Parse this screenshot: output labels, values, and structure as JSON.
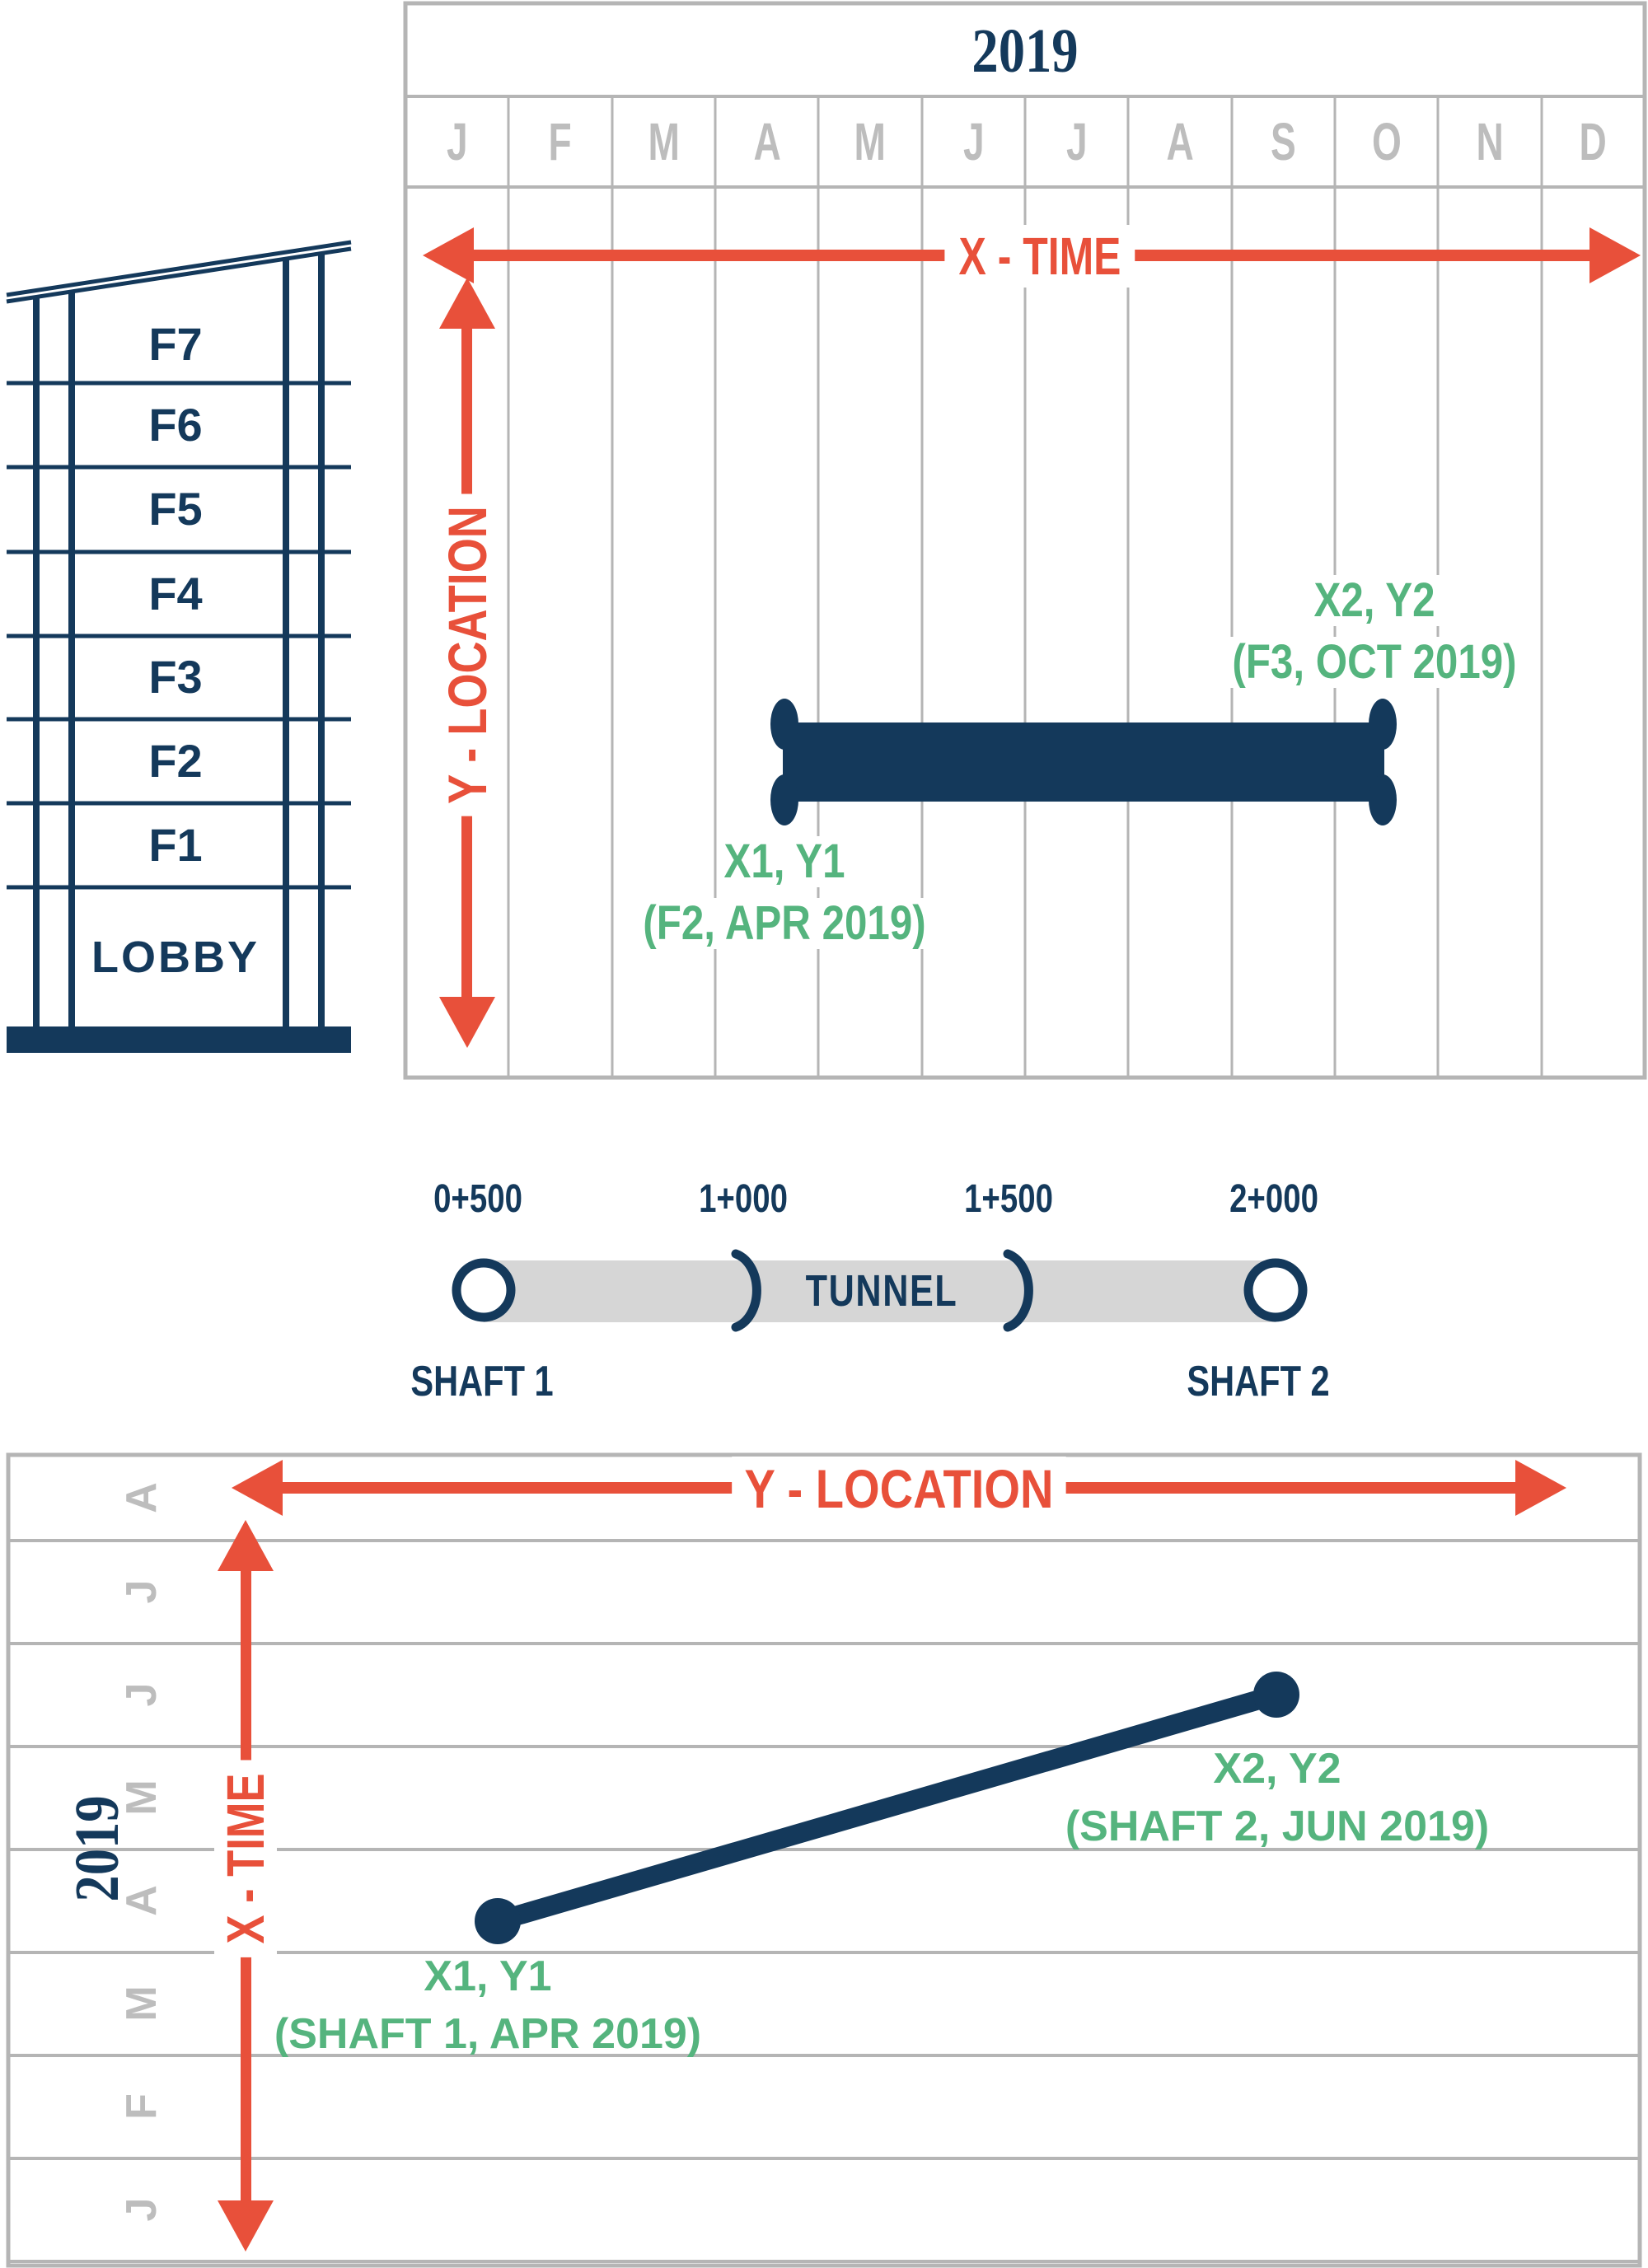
{
  "top_chart": {
    "year": "2019",
    "months": [
      "J",
      "F",
      "M",
      "A",
      "M",
      "J",
      "J",
      "A",
      "S",
      "O",
      "N",
      "D"
    ],
    "x_axis_label": "X - TIME",
    "y_axis_label": "Y - LOCATION",
    "point1": {
      "name": "X1, Y1",
      "coords": "(F2, APR 2019)"
    },
    "point2": {
      "name": "X2, Y2",
      "coords": "(F3, OCT 2019)"
    },
    "bar": {
      "start_month": "APR",
      "end_month": "OCT",
      "start_floor": "F2",
      "end_floor": "F3"
    }
  },
  "building": {
    "floors": [
      "F7",
      "F6",
      "F5",
      "F4",
      "F3",
      "F2",
      "F1"
    ],
    "lobby": "LOBBY"
  },
  "tunnel": {
    "chainages": [
      "0+500",
      "1+000",
      "1+500",
      "2+000"
    ],
    "label": "TUNNEL",
    "shaft1": "SHAFT 1",
    "shaft2": "SHAFT 2"
  },
  "bottom_chart": {
    "year": "2019",
    "months": [
      "A",
      "J",
      "J",
      "M",
      "A",
      "M",
      "F",
      "J"
    ],
    "x_axis_label": "X - TIME",
    "y_axis_label": "Y - LOCATION",
    "point1": {
      "name": "X1, Y1",
      "coords": "(SHAFT 1, APR 2019)"
    },
    "point2": {
      "name": "X2, Y2",
      "coords": "(SHAFT 2, JUN 2019)"
    },
    "line": {
      "from": "SHAFT 1 / APR 2019",
      "to": "SHAFT 2 / JUN 2019"
    }
  },
  "colors": {
    "navy": "#14395B",
    "red": "#E8503A",
    "green": "#55B47E",
    "grid_gray": "#B5B5B5",
    "letter_gray": "#BDBDBD",
    "tunnel_fill": "#D6D6D6"
  }
}
